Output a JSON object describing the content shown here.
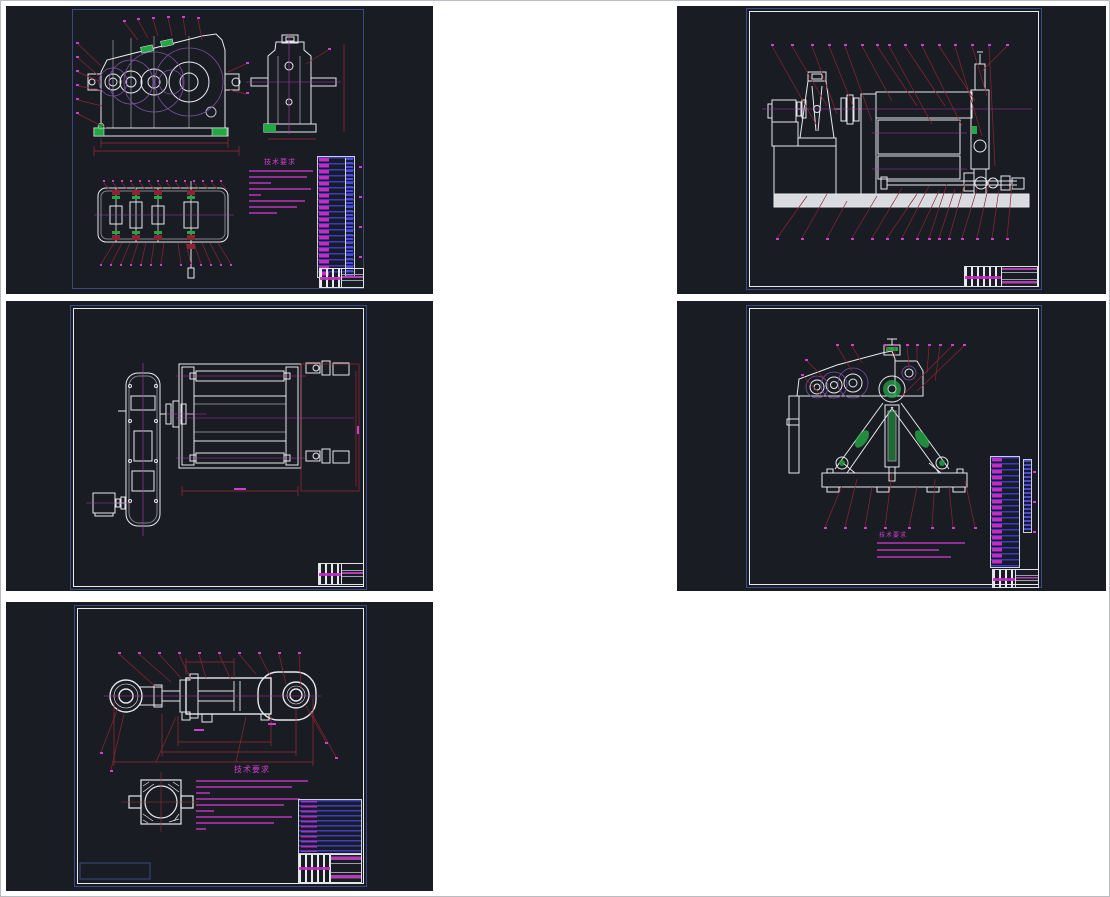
{
  "page": {
    "background": "#ffffff",
    "border_color": "#b9bcc2",
    "description_note": ""
  },
  "palette": {
    "panel_background": "#1a1c23",
    "line_white": "#e8e9ec",
    "frame_blue": "#3b4a84",
    "leader_red": "#8c2531",
    "phantom_purple": "#7b4fa0",
    "centerline_magenta": "#b136b1",
    "balloon_magenta": "#cf3fcf",
    "hatch_green": "#23a845",
    "bom_text_blue": "#3e3eec",
    "bom_fill_magenta": "#c42ac4",
    "base_fill_gray": "#d9dbe1"
  },
  "panels": [
    {
      "id": "p1",
      "notes_heading": "技术要求"
    },
    {
      "id": "p2"
    },
    {
      "id": "p3"
    },
    {
      "id": "p4",
      "notes_heading": "技术要求"
    },
    {
      "id": "p5",
      "notes_heading": "技术要求"
    }
  ]
}
